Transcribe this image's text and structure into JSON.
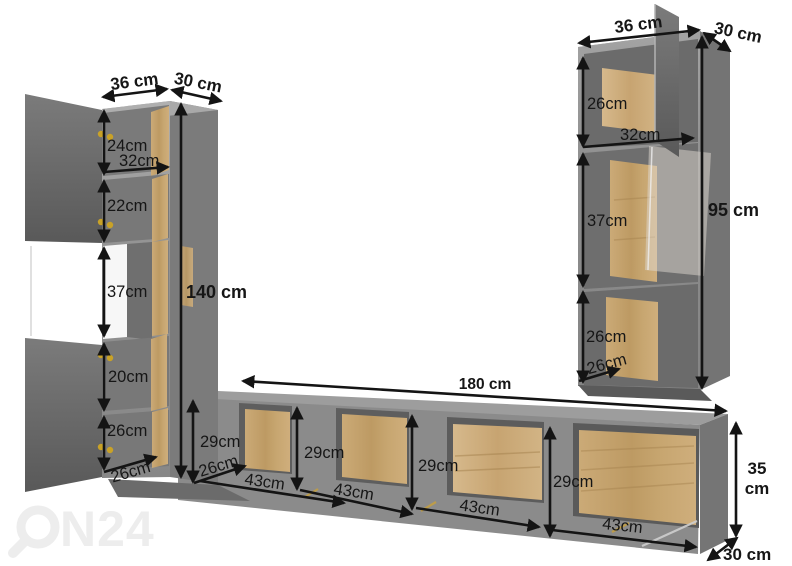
{
  "watermark": {
    "text_after_logo": "N24"
  },
  "left_cabinet": {
    "width_top": "36 cm",
    "depth_top": "30 cm",
    "height": "140 cm",
    "inner_width": "32cm",
    "inner_depth": "26cm",
    "shelf_heights": [
      "24cm",
      "22cm",
      "37cm",
      "20cm",
      "26cm"
    ]
  },
  "right_cabinet": {
    "width_top": "36 cm",
    "depth_top": "30 cm",
    "height": "95 cm",
    "inner_width": "32cm",
    "inner_depth": "26cm",
    "shelf_heights": [
      "26cm",
      "37cm",
      "26cm"
    ]
  },
  "tv_stand": {
    "width": "180 cm",
    "height_line1": "35",
    "height_line2": "cm",
    "depth": "30 cm",
    "inner_depth": "26cm",
    "compartment_heights": [
      "29cm",
      "29cm",
      "29cm",
      "29cm"
    ],
    "compartment_widths": [
      "43cm",
      "43cm",
      "43cm",
      "43cm"
    ]
  }
}
